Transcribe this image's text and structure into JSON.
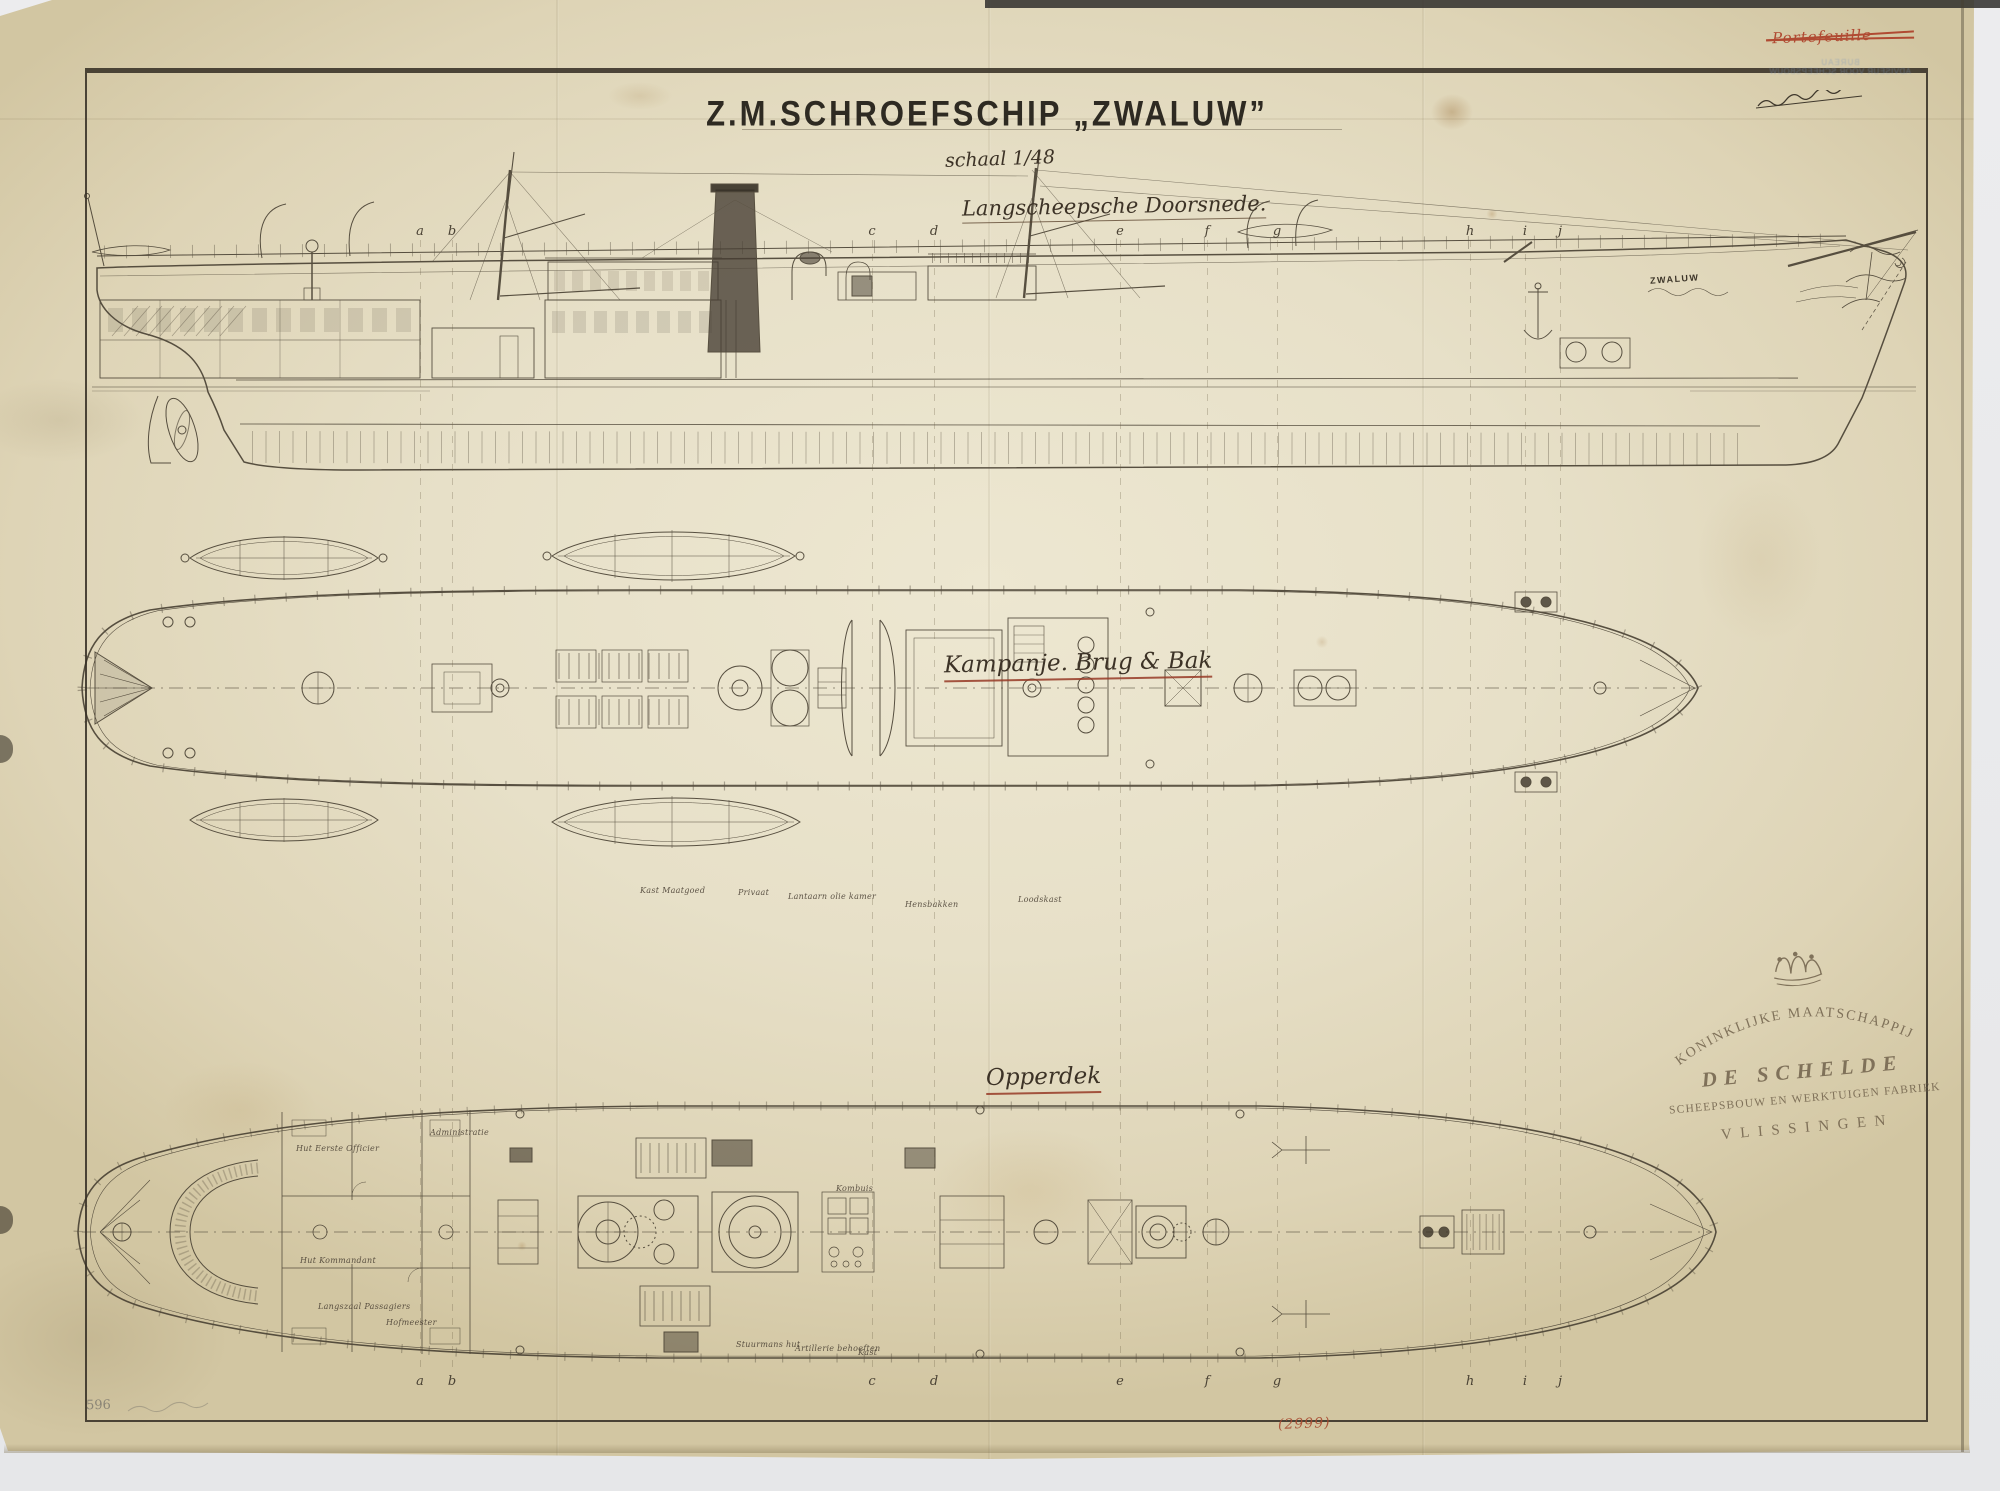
{
  "colors": {
    "paper": "#e6dfc6",
    "paper_edge": "#d3c7a4",
    "ink": "#4b4335",
    "ink_dark": "#2c2820",
    "red_ink": "#b04a32",
    "underline_red": "#96402c",
    "blue_stamp": "#7d96ba",
    "stamp_brown": "#6f604a",
    "pencil": "#8b8576",
    "background": "#e8e9ea"
  },
  "header": {
    "title": "Z.M.SCHROEFSCHIP „ZWALUW”",
    "scale_note": "schaal 1/48",
    "section_label": "Langscheepsche Doorsnede."
  },
  "plans": {
    "middle_label": "Kampanje. Brug & Bak",
    "bottom_label": "Opperdek"
  },
  "hull_name": "ZWALUW",
  "stamp": {
    "line1": "KONINKLIJKE MAATSCHAPPIJ",
    "line2": "DE SCHELDE",
    "line3": "SCHEEPSBOUW EN WERKTUIGEN FABRIEK",
    "line4": "VLISSINGEN"
  },
  "annotations": {
    "red_crossed_out": "Portefeuille",
    "blue_stamp_line1": "BUREAU",
    "blue_stamp_line2": "ADVISEUR VOOR SCHEEPSBOUW",
    "pencil_number": "596",
    "red_number": "(2999)"
  },
  "stations": {
    "letters": [
      "a",
      "b",
      "c",
      "d",
      "e",
      "f",
      "g",
      "h",
      "i",
      "j"
    ],
    "x": [
      420,
      452,
      872,
      934,
      1120,
      1207,
      1277,
      1470,
      1525,
      1560
    ],
    "top_y": 224,
    "bottom_y": 1374
  },
  "room_labels": [
    {
      "x": 296,
      "y": 1144,
      "text": "Hut Eerste Officier"
    },
    {
      "x": 430,
      "y": 1128,
      "text": "Administratie"
    },
    {
      "x": 300,
      "y": 1256,
      "text": "Hut Kommandant"
    },
    {
      "x": 318,
      "y": 1302,
      "text": "Langszaal Passagiers"
    },
    {
      "x": 386,
      "y": 1318,
      "text": "Hofmeester"
    },
    {
      "x": 640,
      "y": 886,
      "text": "Kast Maatgoed"
    },
    {
      "x": 738,
      "y": 888,
      "text": "Privaat"
    },
    {
      "x": 788,
      "y": 892,
      "text": "Lantaarn olie kamer"
    },
    {
      "x": 905,
      "y": 900,
      "text": "Hensbakken"
    },
    {
      "x": 1018,
      "y": 895,
      "text": "Loodskast"
    },
    {
      "x": 836,
      "y": 1184,
      "text": "Kombuis"
    },
    {
      "x": 736,
      "y": 1340,
      "text": "Stuurmans hut"
    },
    {
      "x": 795,
      "y": 1344,
      "text": "Artillerie behoeften"
    },
    {
      "x": 858,
      "y": 1348,
      "text": "Kast"
    }
  ]
}
